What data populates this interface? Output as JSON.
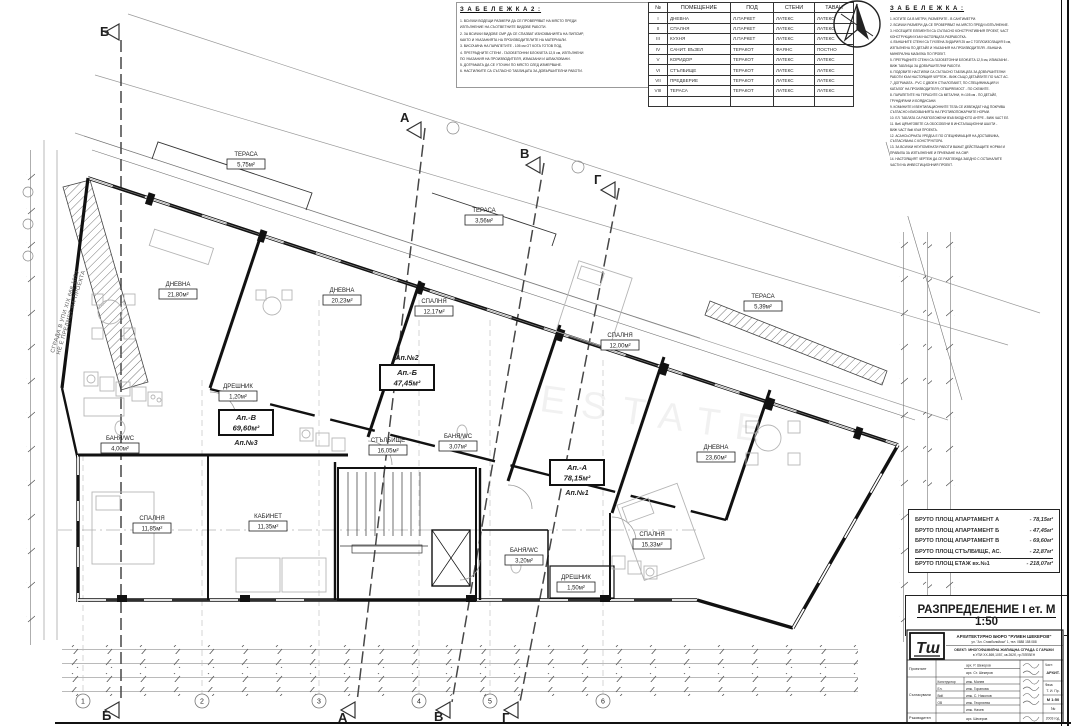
{
  "watermark": "ESTATE",
  "notes_left": {
    "title": "З А Б Е Л Е Ж К А   2 :",
    "body": "1. ВСИЧКИ ВОДЕЩИ РАЗМЕРИ ДА СЕ ПРОВЕРЯВАТ НА МЯСТО ПРЕДИ\nИЗПЪЛНЕНИЕ НА СЪОТВЕТНИТЕ ВИДОВЕ РАБОТИ.\n2. ЗА ВСИЧКИ ВИДОВЕ СМР ДА СЕ СПАЗВАТ ИЗИСКВАНИЯТА НА ПИПСМР,\nКАКТО И УКАЗАНИЯТА НА ПРОИЗВОДИТЕЛИТЕ НА МАТЕРИАЛИ.\n3. ВИСОЧИНА НА ПАРАПЕТИТЕ - 105 см ОТ КОТА ГОТОВ ПОД.\n4. ПРЕГРАДНИТЕ СТЕНИ - ГАЗОБЕТОННИ БЛОКЧЕТА 12,5 см, ИЗПЪЛНЕНИ\nПО УКАЗАНИЯ НА ПРОИЗВОДИТЕЛЯ, ИЗМАЗАНИ И ШПАКЛОВАНИ.\n5. ДОГРАМАТА ДА СЕ УТОЧНИ ПО МЯСТО СЛЕД ИЗМЕРВАНЕ.\n6. НАСТИЛКИТЕ СА СЪГЛАСНО ТАБЛИЦАТА ЗА ДОВЪРШИТЕЛНИ РАБОТИ."
  },
  "finish_table": {
    "headers": [
      "№",
      "ПОМЕЩЕНИЕ",
      "ПОД",
      "СТЕНИ",
      "ТАВАН"
    ],
    "rows": [
      [
        "I",
        "ДНЕВНА",
        "Л.ПАРКЕТ",
        "ЛАТЕКС",
        "ЛАТЕКС"
      ],
      [
        "II",
        "СПАЛНЯ",
        "Л.ПАРКЕТ",
        "ЛАТЕКС",
        "ЛАТЕКС"
      ],
      [
        "III",
        "КУХНЯ",
        "Л.ПАРКЕТ",
        "ЛАТЕКС",
        "ЛАТЕКС"
      ],
      [
        "IV",
        "САНИТ. ВЪЗЕЛ",
        "ТЕРАКОТ",
        "ФАЯНС",
        "ПОСТНО"
      ],
      [
        "V",
        "КОРИДОР",
        "ТЕРАКОТ",
        "ЛАТЕКС",
        "ЛАТЕКС"
      ],
      [
        "VI",
        "СТЪЛБИЩЕ",
        "ТЕРАКОТ",
        "ЛАТЕКС",
        "ЛАТЕКС"
      ],
      [
        "VII",
        "ПРЕДВЕРИЕ",
        "ТЕРАКОТ",
        "ЛАТЕКС",
        "ЛАТЕКС"
      ],
      [
        "VIII",
        "ТЕРАСА",
        "ТЕРАКОТ",
        "ЛАТЕКС",
        "ЛАТЕКС"
      ],
      [
        "",
        "",
        "",
        "",
        ""
      ]
    ]
  },
  "notes_right": {
    "title": "З А Б Е Л Е Ж К А :",
    "body": "1. КОТИТЕ СА В МЕТРИ, РАЗМЕРИТЕ - В САНТИМЕТРИ.\n2. ВСИЧКИ РАЗМЕРИ ДА СЕ ПРОВЕРЯВАТ НА МЯСТО ПРЕДИ ИЗПЪЛНЕНИЕ.\n3. НОСЕЩИТЕ ЕЛЕМЕНТИ СА СЪГЛАСНО КОНСТРУКТИВНИЯ ПРОЕКТ, ЧАСТ\nКОНСТРУКЦИИ КЪМ НАСТОЯЩАТА РАЗРАБОТКА.\n4. ВЪНШНИТЕ СТЕНИ СА ТУХЛЕНА ЗИДАРИЯ 25 см С ТОПЛОИЗОЛАЦИЯ 5 см,\nИЗПЪЛНЕНА ПО ДЕТАЙЛ И УКАЗАНИЯ НА ПРОИЗВОДИТЕЛЯ - ВЪНШНА\nМИНЕРАЛНА МАЗИЛКА ПО ПРОЕКТ.\n5. ПРЕГРАДНИТЕ СТЕНИ СА ГАЗОБЕТОННИ БЛОКЧЕТА 12,5 см, ИЗМАЗАНИ -\nВИЖ ТАБЛИЦА ЗА ДОВЪРШИТЕЛНИ РАБОТИ.\n6. ПОДОВИТЕ НАСТИЛКИ СА СЪГЛАСНО ТАБЛИЦАТА ЗА ДОВЪРШИТЕЛНИ\nРАБОТИ КЪМ НАСТОЯЩИЯ ЧЕРТЕЖ - ВИЖ СЪЩО ДЕТАЙЛИТЕ ПО ЧАСТ АС.\n7. ДОГРАМАТА - PVC С ДВОЕН СТЪКЛОПАКЕТ, ПО СПЕЦИФИКАЦИЯ И\nКАТАЛОГ НА ПРОИЗВОДИТЕЛЯ; ОТВАРЯЕМОСТ - ПО СХЕМИТЕ.\n8. ПАРАПЕТИТЕ НА ТЕРАСИТЕ СА МЕТАЛНИ, Н=105 см - ПО ДЕТАЙЛ,\nГРУНДИРАНИ И БОЯДИСАНИ.\n9. КОМИНИТЕ И ВЕНТИЛАЦИОННИТЕ ТЕЛА СЕ ИЗВЕЖДАТ НАД ПОКРИВА\nСЪГЛАСНО ИЗИСКВАНИЯТА НА ПРОТИВОПОЖАРНИТЕ НОРМИ.\n10. ЕЛ. ТАБЛАТА СА РАЗПОЛОЖЕНИ ВЪВ ВХОДНОТО АНТРЕ - ВИЖ ЧАСТ ЕЛ.\n11. ВиК ЩРАНГОВЕТЕ СА ОБОСОБЕНИ В ИНСТАЛАЦИОННИ ШАХТИ -\nВИЖ ЧАСТ ВиК КЪМ ПРОЕКТА.\n12. АСАНСЬОРНАТА УРЕДБА Е ПО СПЕЦИФИКАЦИЯ НА ДОСТАВЧИКА,\nСЪГЛАСУВАНА С КОНСТРУКТОРА.\n13. ЗА ВСИЧКИ НЕУПОМЕНАТИ РАБОТИ ВАЖАТ ДЕЙСТВАЩИТЕ НОРМИ И\nПРАВИЛА ЗА ИЗПЪЛНЕНИЕ И ПРИЕМАНЕ НА СМР.\n14. НАСТОЯЩИЯТ ЧЕРТЕЖ ДА СЕ РАЗГЛЕЖДА ЗАЕДНО С ОСТАНАЛИТЕ\nЧАСТИ НА ИНВЕСТИЦИОННИЯ ПРОЕКТ."
  },
  "rooms": [
    {
      "name": "ДНЕВНА",
      "area": "21,80м²"
    },
    {
      "name": "СПАЛНЯ",
      "area": "11,85м²"
    },
    {
      "name": "КАБИНЕТ",
      "area": "11,35м²"
    },
    {
      "name": "БАНЯ/WC",
      "area": "4,00м²"
    },
    {
      "name": "ДРЕШНИК",
      "area": "1,20м²"
    },
    {
      "name": "ДНЕВНА",
      "area": "20,23м²"
    },
    {
      "name": "СПАЛНЯ",
      "area": "12,17м²"
    },
    {
      "name": "БАНЯ/WC",
      "area": "3,07м²"
    },
    {
      "name": "СТЪЛБИЩЕ",
      "area": "16,05м²"
    },
    {
      "name": "СПАЛНЯ",
      "area": "12,00м²"
    },
    {
      "name": "ДНЕВНА",
      "area": "23,60м²"
    },
    {
      "name": "СПАЛНЯ",
      "area": "15,33м²"
    },
    {
      "name": "БАНЯ/WC",
      "area": "3,20м²"
    },
    {
      "name": "ДРЕШНИК",
      "area": "1,50м²"
    },
    {
      "name": "ТЕРАСА",
      "area": "5,75м²"
    },
    {
      "name": "ТЕРАСА",
      "area": "3,56м²"
    },
    {
      "name": "ТЕРАСА",
      "area": "5,39м²"
    }
  ],
  "apartments": [
    {
      "code": "Ап.-А",
      "area": "78,15м²",
      "number": "Ап.№1"
    },
    {
      "code": "Ап.-Б",
      "area": "47,45м²",
      "number": "Ап.№2"
    },
    {
      "code": "Ап.-В",
      "area": "69,60м²",
      "number": "Ап.№3"
    }
  ],
  "axes": {
    "top": [
      "Б",
      "А",
      "В",
      "Г"
    ],
    "bottom": [
      "Б",
      "А",
      "В",
      "Г"
    ]
  },
  "grid_bubbles": [
    "1",
    "2",
    "3",
    "4",
    "5",
    "6"
  ],
  "side_note": "СГРАДА В УПИ XIX 668,1073\nНЕ Е ПРЕДМЕТ НА ПРОЕКТА",
  "summary": {
    "rows": [
      {
        "label": "БРУТО ПЛОЩ АПАРТАМЕНТ А",
        "value": "- 78,15м²"
      },
      {
        "label": "БРУТО ПЛОЩ АПАРТАМЕНТ Б",
        "value": "- 47,45м²"
      },
      {
        "label": "БРУТО ПЛОЩ АПАРТАМЕНТ В",
        "value": "- 69,60м²"
      },
      {
        "label": "БРУТО ПЛОЩ СТЪЛБИЩЕ, АС.",
        "value": "- 22,87м²"
      },
      {
        "label": "БРУТО ПЛОЩ ЕТАЖ вх.№1",
        "value": "- 218,07м²"
      }
    ]
  },
  "main_title": "РАЗПРЕДЕЛЕНИЕ I ет. М 1:50",
  "title_block": {
    "logo": "Тш",
    "firm": "АРХИТЕКТУРНО БЮРО \"РУМЕН ШЕКЕРОВ\"",
    "firm_addr": "ул. \"Ал. Стамболийски\" 1, тел. 0888 158 088",
    "object1": "ОБЕКТ: МНОГОФАМИЛНА ЖИЛИЩНА СГРАДА С ГАРАЖИ",
    "object2": "в УПИ XX-869,1057, кв.262б, гр.ПЛЕВЕН",
    "roles": [
      "Проектант",
      "Съгласували",
      "Ръководител"
    ],
    "designers": [
      "арх. Р. Шекеров",
      "арх. Ст. Шекеров"
    ],
    "consultants": [
      {
        "part": "Конструктор",
        "name": "инж. Монев"
      },
      {
        "part": "Ел.",
        "name": "инж. Горанова"
      },
      {
        "part": "ВиК",
        "name": "инж. С. Николов"
      },
      {
        "part": "ОВ",
        "name": "инж. Георгиева"
      },
      {
        "part": "",
        "name": "инж. Начев"
      }
    ],
    "leader": "арх. Шекеров",
    "meta": {
      "part_label": "Част:",
      "part": "АРХИТ.",
      "phase_label": "Фаза:",
      "phase": "Т. И. Пр.",
      "scale": "М 1:50",
      "num": "№",
      "year": "2003 год."
    }
  }
}
